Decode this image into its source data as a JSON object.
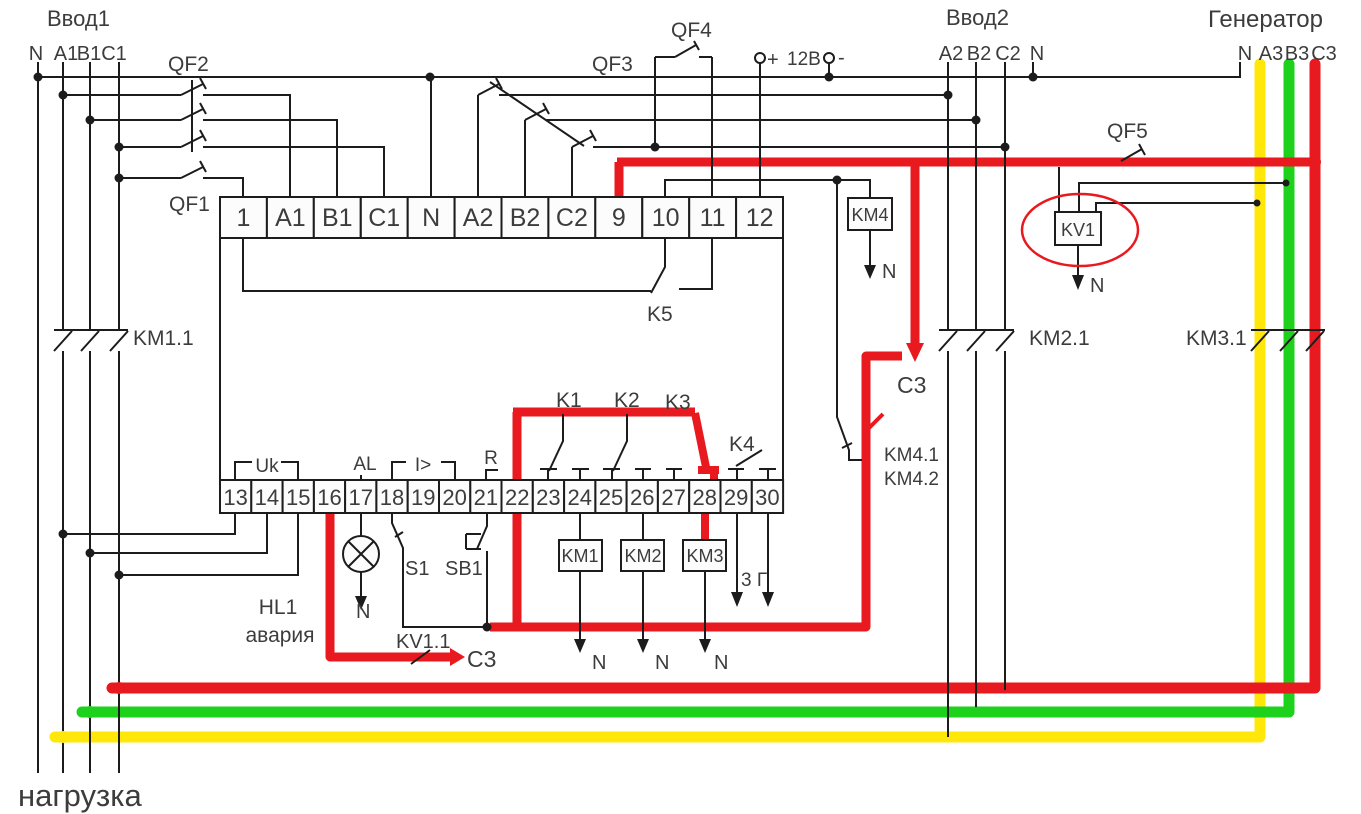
{
  "colors": {
    "phase_a_yellow": "#ffe70a",
    "phase_b_green": "#1dd11d",
    "phase_c_red": "#e8191f",
    "wire": "#1c1c1c",
    "text": "#3c3c3c"
  },
  "sources": {
    "input1": {
      "title": "Ввод1",
      "wires": [
        "N",
        "A1",
        "B1",
        "C1"
      ]
    },
    "input2": {
      "title": "Ввод2",
      "wires": [
        "A2",
        "B2",
        "C2",
        "N"
      ]
    },
    "generator": {
      "title": "Генератор",
      "wires": [
        "N",
        "A3",
        "B3",
        "C3"
      ]
    },
    "battery": {
      "plus": "+",
      "voltage": "12В",
      "minus": "-"
    },
    "load": {
      "title": "нагрузка"
    }
  },
  "device": {
    "terminals_top": [
      "1",
      "A1",
      "B1",
      "C1",
      "N",
      "A2",
      "B2",
      "C2",
      "9",
      "10",
      "11",
      "12"
    ],
    "terminals_bottom": [
      "13",
      "14",
      "15",
      "16",
      "17",
      "18",
      "19",
      "20",
      "21",
      "22",
      "23",
      "24",
      "25",
      "26",
      "27",
      "28",
      "29",
      "30"
    ],
    "groups": {
      "uk": "Uk",
      "al": "AL",
      "current": "I>",
      "r": "R"
    }
  },
  "components": {
    "qf1": "QF1",
    "qf2": "QF2",
    "qf3": "QF3",
    "qf4": "QF4",
    "qf5": "QF5",
    "km1": "KM1",
    "km2": "KM2",
    "km3": "KM3",
    "km4": "KM4",
    "kv1": "KV1",
    "km1_1": "KM1.1",
    "km2_1": "KM2.1",
    "km3_1": "KM3.1",
    "km4_1": "KM4.1",
    "km4_2": "KM4.2",
    "kv1_1": "KV1.1",
    "k1": "K1",
    "k2": "K2",
    "k3": "K3",
    "k4": "K4",
    "k5": "K5",
    "s1": "S1",
    "sb1": "SB1",
    "hl1": "HL1",
    "hl1_caption": "авария"
  },
  "annotations": {
    "c3_feed": "С3",
    "c3_out": "С3",
    "neutral": "N",
    "start_out": "3 Г"
  }
}
